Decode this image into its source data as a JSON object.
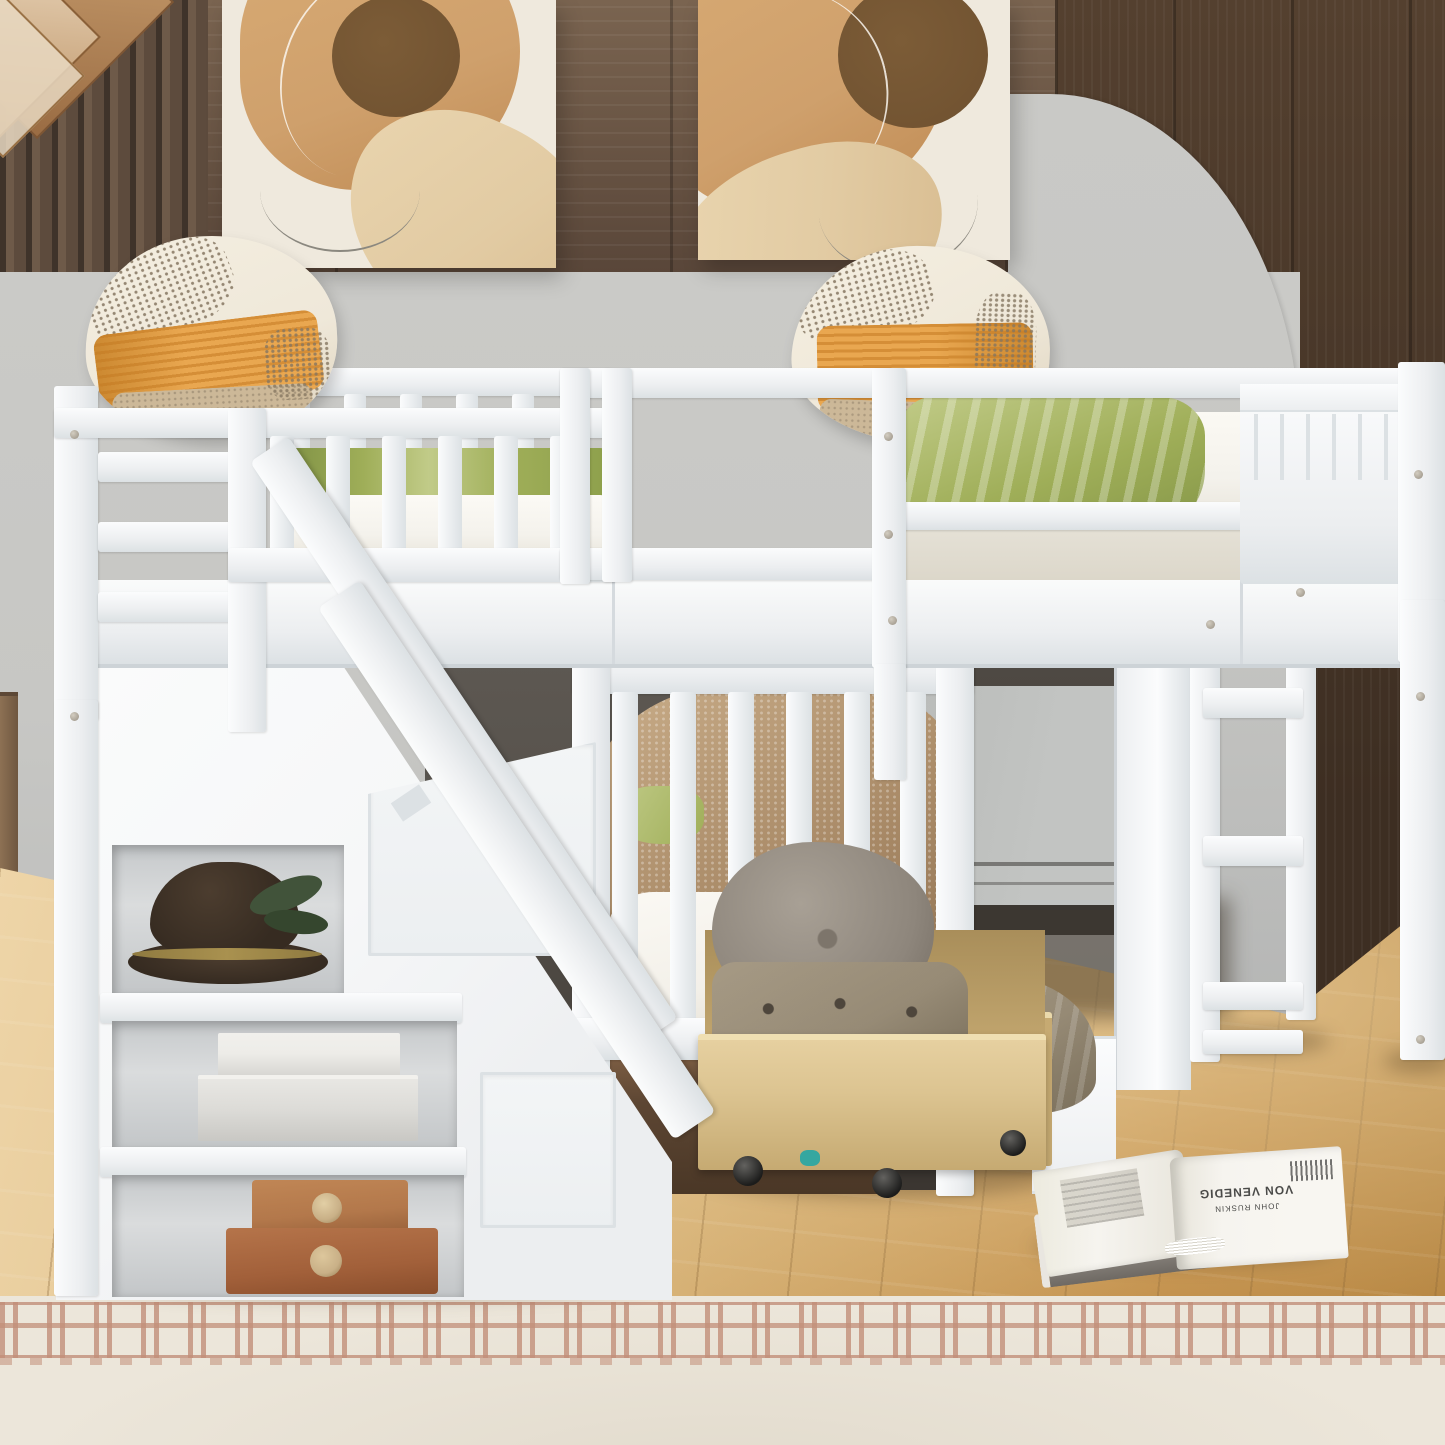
{
  "scene": {
    "description": "Bedroom product photo: white L-shaped triple bunk bed - twin bunk with storage staircase, loft bed with ladder, under-bed storage drawers",
    "setting": "kids bedroom with wood plank accent wall, gray arch decal, light hardwood floor and cream rug"
  },
  "objects": {
    "wall_wood_band": "dark wood plank upper wall",
    "wall_slats": "vertical wood slat accent",
    "wall_arch": "gray painted arch on wood wall",
    "painting_left": "abstract beige canvas print",
    "painting_right": "abstract beige canvas print",
    "pendant_lamp": "geometric copper-glass pendant lamp",
    "pillow_left": "cream-orange woven accent pillow on upper bunk",
    "pillow_right": "cream-orange woven accent pillow on loft bed",
    "upper_bunk": "upper twin bed with guardrails and green sheet",
    "loft_bed": "loft bed with green blanket and grooved headboard",
    "staircase": "storage staircase with handrail and cubbies",
    "hat": "brown felt hat with leaves",
    "white_boxes": "stacked white keepsake boxes",
    "leather_cases": "stacked brown leather cases",
    "lower_bed": "lower twin bed with taupe boucle blanket",
    "underbed_drawer": "dark walnut under-bed drawer",
    "rolling_drawers": "two natural-wood rolling storage drawers with cushions and folded clothes",
    "gray_panel": "fold-flat gray desk panel under loft",
    "ladder": "white loft ladder",
    "side_cabinet": "white side cabinet under loft",
    "floor": "light oak plank floor",
    "rug": "cream rug with terracotta greek-key border",
    "book": "open book lying on a gray hardcover on the floor"
  },
  "book": {
    "author_line": "JOHN RUSKIN",
    "title_line": "VON VENEDIG"
  },
  "palette": {
    "wood-band": "#7a6450",
    "wood-dark": "#594639",
    "slat": "#6e5a49",
    "slat-gap": "#3f332a",
    "wood-right": "#54402f",
    "wood-right-dark": "#3d2e22",
    "wall": "#c7c7c4",
    "wall-low": "#b5b6b5",
    "canvas": "#efe9dd",
    "p-tan": "#cfa06c",
    "p-brown": "#6f5130",
    "p-beige": "#e2cba3",
    "p-line": "#8b887f",
    "w-hi": "#fbfcfd",
    "w": "#f6f7f8",
    "w-mid": "#eceef0",
    "w-sh": "#dce1e4",
    "w-deep": "#c7cdd2",
    "under": "#55504a",
    "under-deep": "#3b3631",
    "panel": "#b8bab8",
    "matt": "#f4f2ec",
    "matt-sh": "#e5e1d6",
    "green": "#9fae58",
    "green-hi": "#c1cb88",
    "green-dk": "#7e9044",
    "pil-cream": "#efe8d9",
    "pil-orange": "#e9a750",
    "pil-orange-dk": "#cc8931",
    "pil-speck": "#857661",
    "pil-tan": "#ccb898",
    "blank": "#a98a67",
    "blank-hi": "#c9ad89",
    "sheet": "#f3f0e9",
    "ply": "#dcc491",
    "ply-dk": "#c6aa72",
    "ply-deep": "#a98e5a",
    "dbrown": "#5d4633",
    "dbrown-hi": "#7e5f44",
    "gpil": "#8e867c",
    "gpil-hi": "#a8a095",
    "khaki": "#968a75",
    "khaki-dk": "#7a6f5b",
    "hat": "#362b21",
    "hat-hi": "#4c3d2f",
    "brass": "#a9914f",
    "leaf": "#41533a",
    "bxw1": "#edece8",
    "bxw2": "#dcdbd7",
    "bxb1": "#b3784b",
    "bxb2": "#a2603a",
    "clasp": "#c9b087",
    "fl1": "#eed5a8",
    "fl2": "#dab77d",
    "fl3": "#c08c46",
    "rug": "#ece6da",
    "rug-acc": "#c28f79",
    "bookg": "#97918a",
    "bookp": "#f6f4ef",
    "bookt": "#4a4a48",
    "teal": "#35a7a0",
    "copper": "#b07a4e",
    "glass": "#e7d8c1",
    "dresser": "#8d7154",
    "shadow": "rgba(74,54,30,0.35)"
  }
}
